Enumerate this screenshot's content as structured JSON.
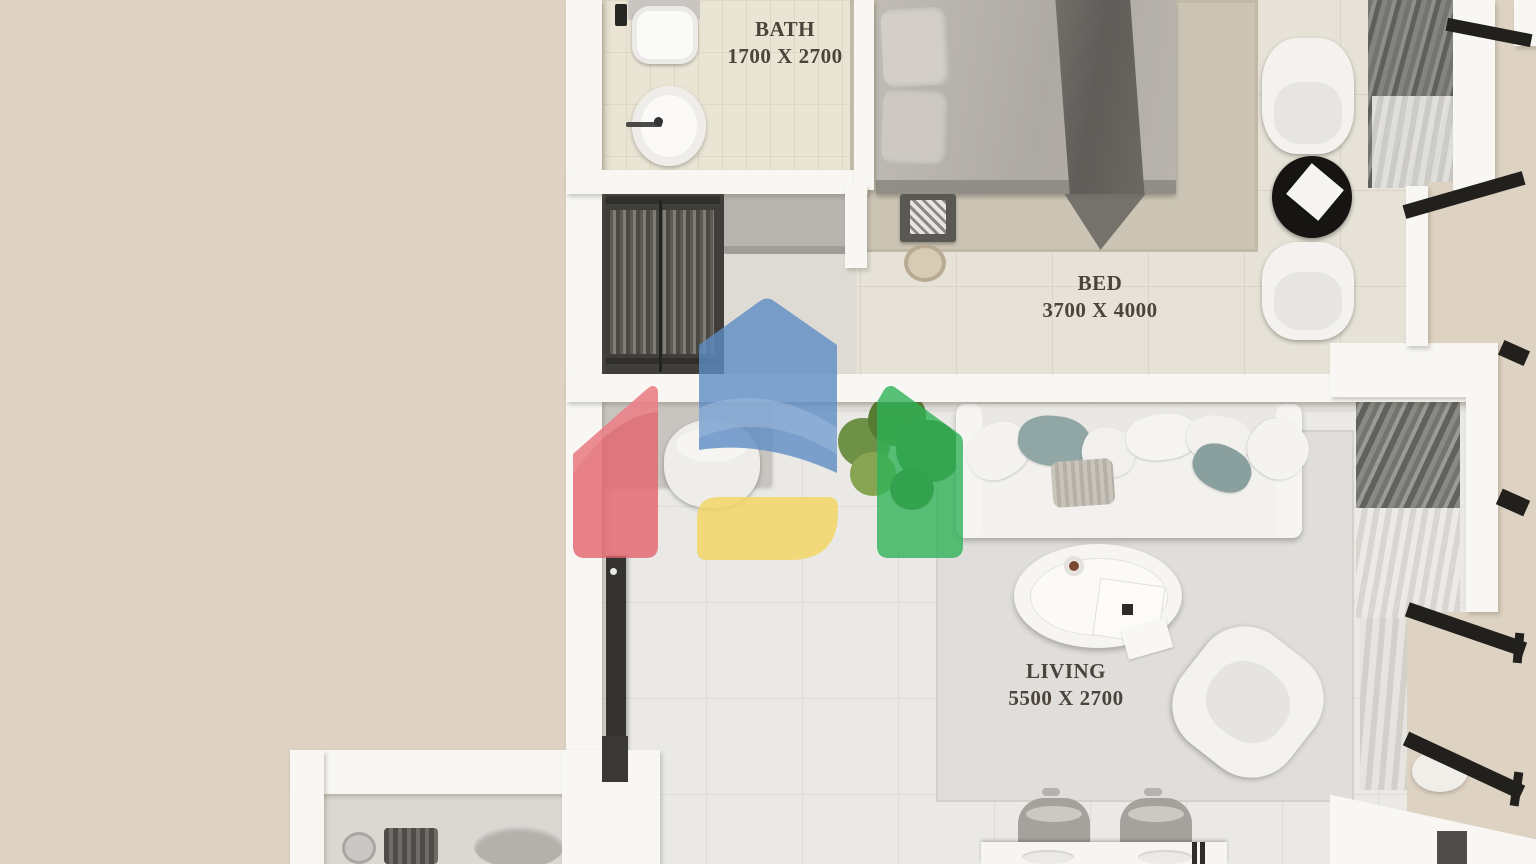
{
  "scene": {
    "type": "3D apartment floor plan render, top-down view",
    "watermark": "four-color house-shapes logo overlay",
    "background_color": "#ded3c2"
  },
  "rooms": [
    {
      "name": "BATH",
      "dimensions": "1700 X 2700",
      "furniture": [
        "toilet",
        "washbasin"
      ]
    },
    {
      "name": "BED",
      "dimensions": "3700 X 4000",
      "furniture": [
        "double-bed",
        "area-rug",
        "nightstand",
        "stool",
        "wardrobe",
        "dresser",
        "armchair",
        "armchair",
        "round-side-table",
        "curtains"
      ]
    },
    {
      "name": "LIVING",
      "dimensions": "5500 X 2700",
      "furniture": [
        "sofa-with-cushions",
        "knit-throw",
        "coffee-table",
        "lounge-chair",
        "area-rug",
        "tv-console",
        "desk-chair",
        "potted-plant",
        "curtains",
        "dining-table",
        "dining-chair",
        "dining-chair",
        "plates"
      ]
    }
  ],
  "logo_colors": {
    "red": "#e2616b",
    "blue": "#5e8cc4",
    "yellow": "#f2d666",
    "green": "#2fb257"
  },
  "palette": {
    "walls": "#f8f7f3",
    "living_floor": "#eae9e5",
    "bedroom_floor": "#e6e2d7",
    "bath_floor": "#e9e4d4",
    "bedroom_rug": "#cbc4b4",
    "window_frame_marks": "#21201c"
  }
}
